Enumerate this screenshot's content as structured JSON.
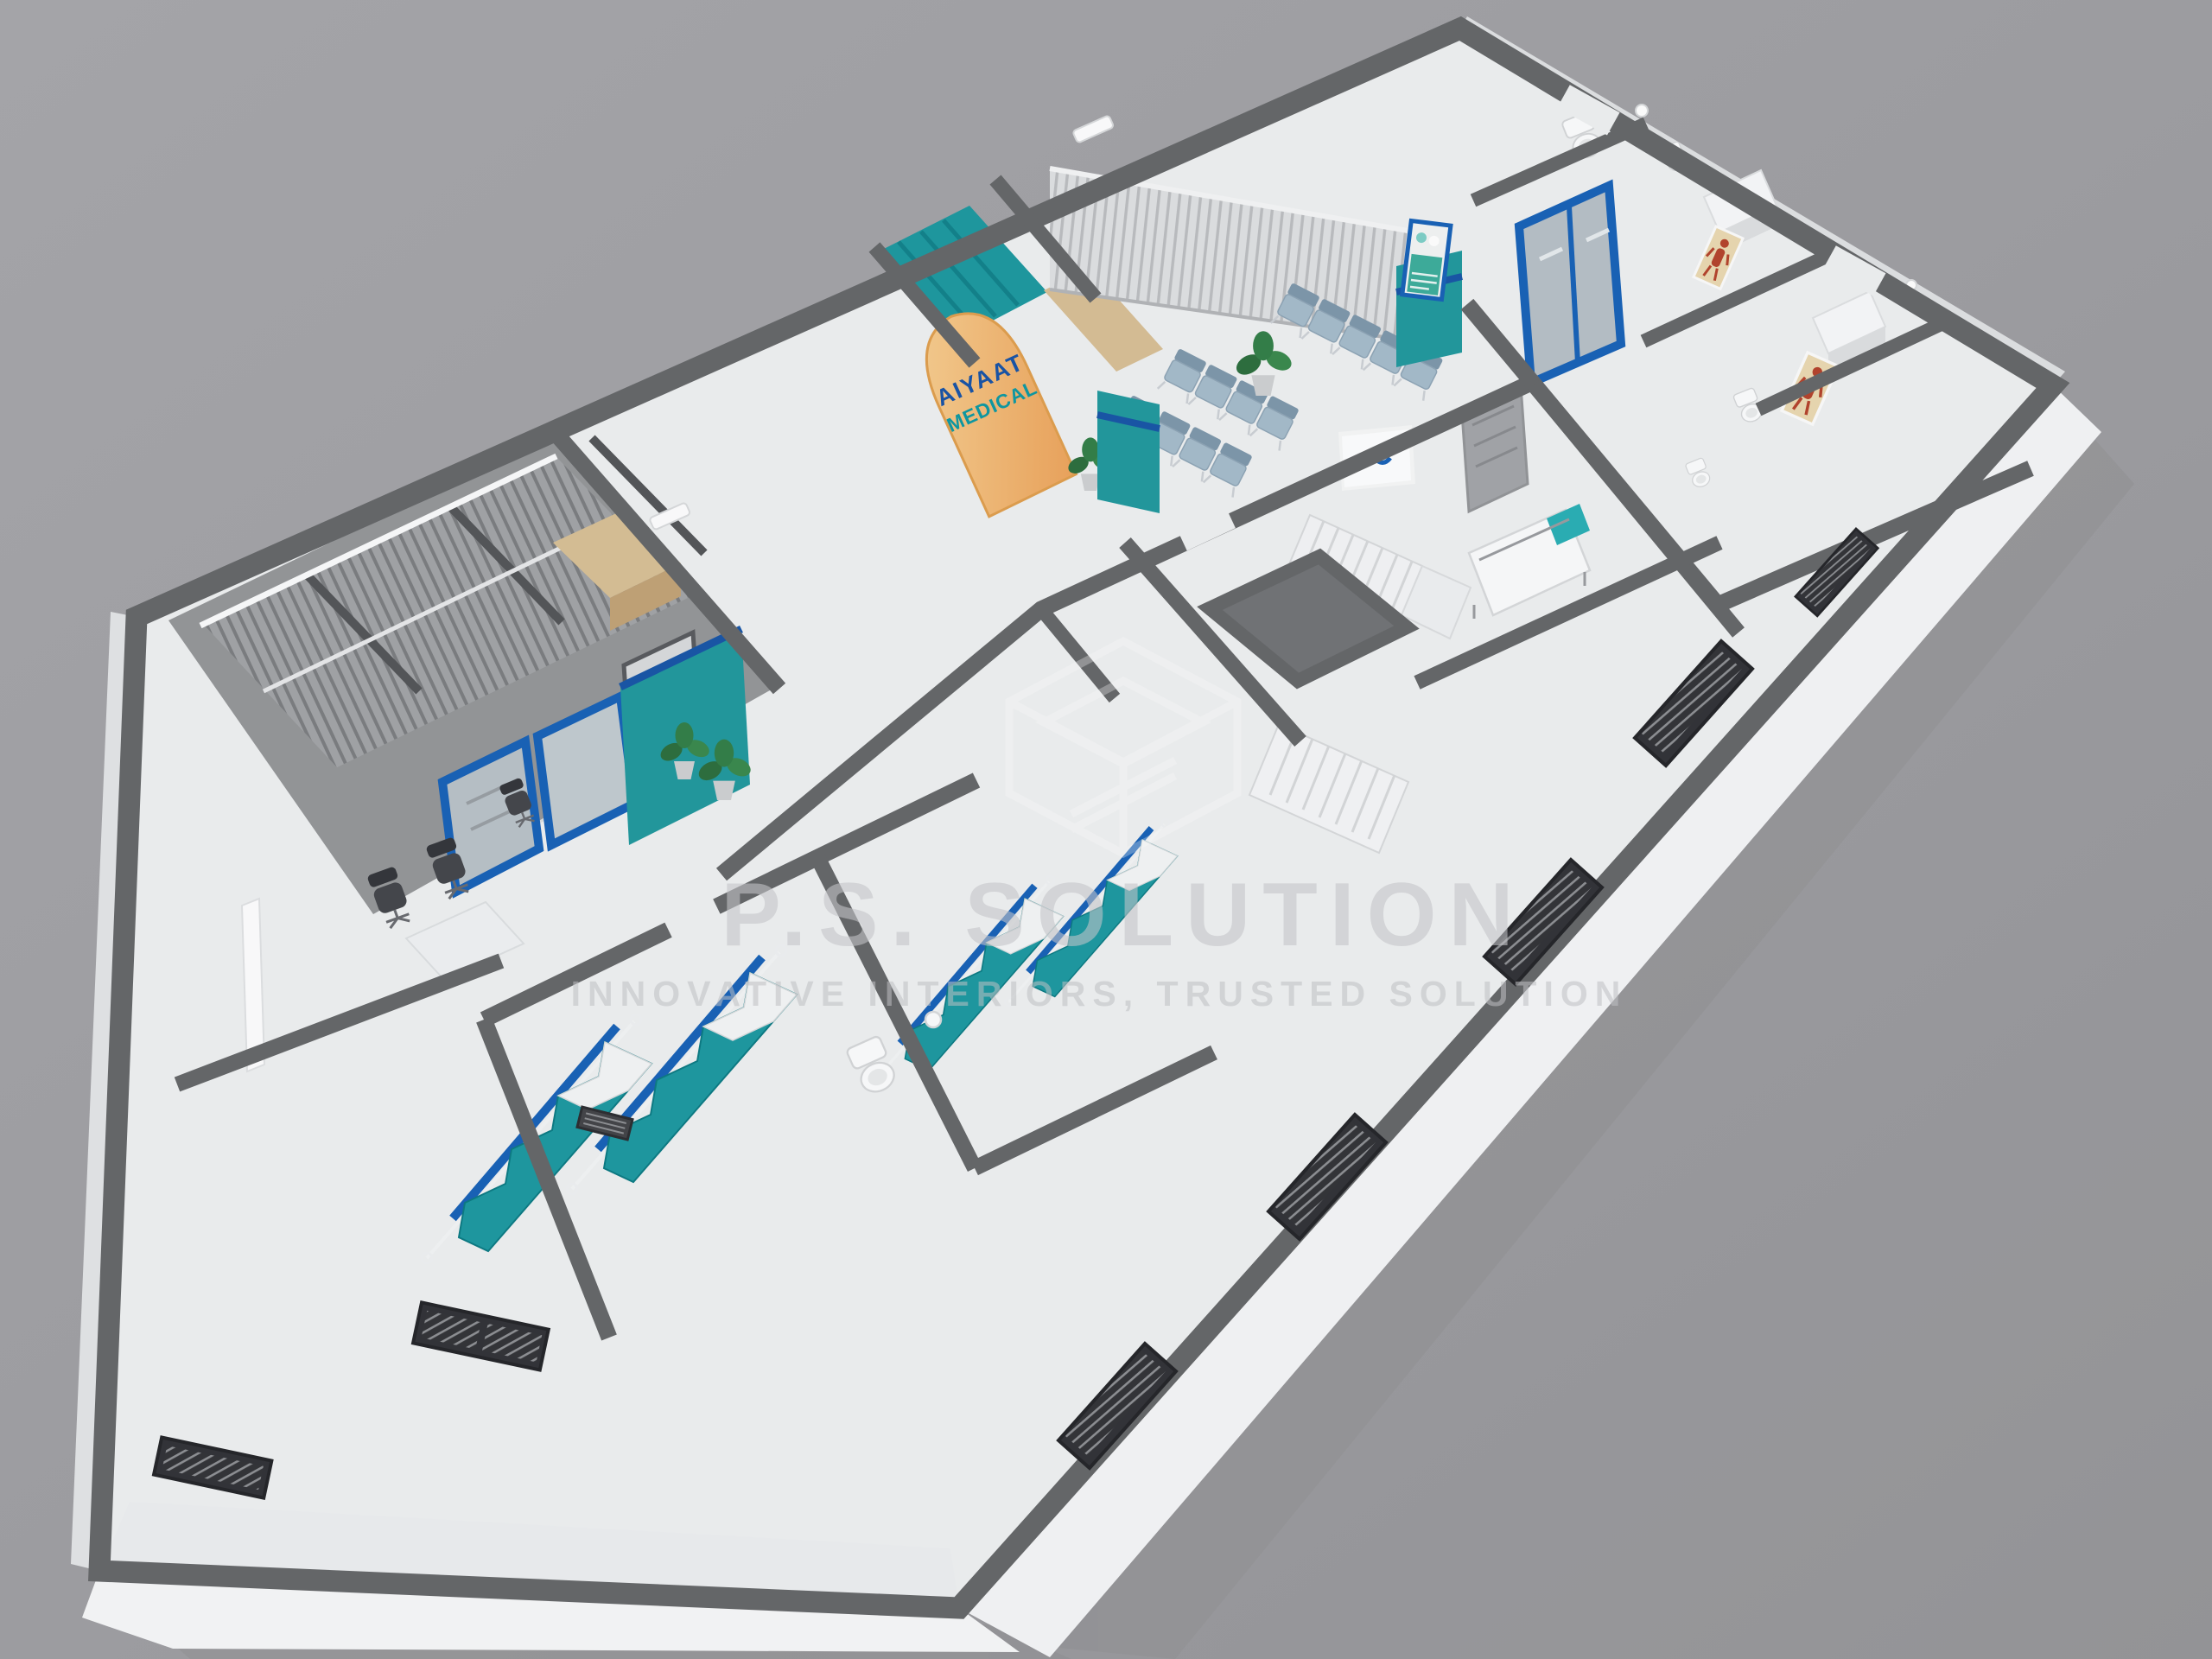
{
  "sign": {
    "line1": "AIYAAT",
    "line2": "MEDICAL",
    "line1_color": "#1a55a8",
    "line2_color": "#0f9aa4",
    "panel_color": "#f2b771"
  },
  "watermark": {
    "title": "P.S. SOLUTION",
    "subtitle": "INNOVATIVE INTERIORS, TRUSTED SOLUTION",
    "logo": "house-wireframe-logo",
    "text_color": "#c9cacd"
  },
  "palette": {
    "background": "#a1a1a5",
    "wall_top": "#67696b",
    "floor": "#eef0f1",
    "accent_blue": "#1a63b8",
    "stripe_blue": "#1a57a8",
    "teal": "#23999f",
    "curtain_teal": "#1f9aa2",
    "wood": "#d8c096",
    "chair_seat": "#a6bccb",
    "office_chair": "#46484d",
    "slab_white": "#f4f5f7"
  }
}
